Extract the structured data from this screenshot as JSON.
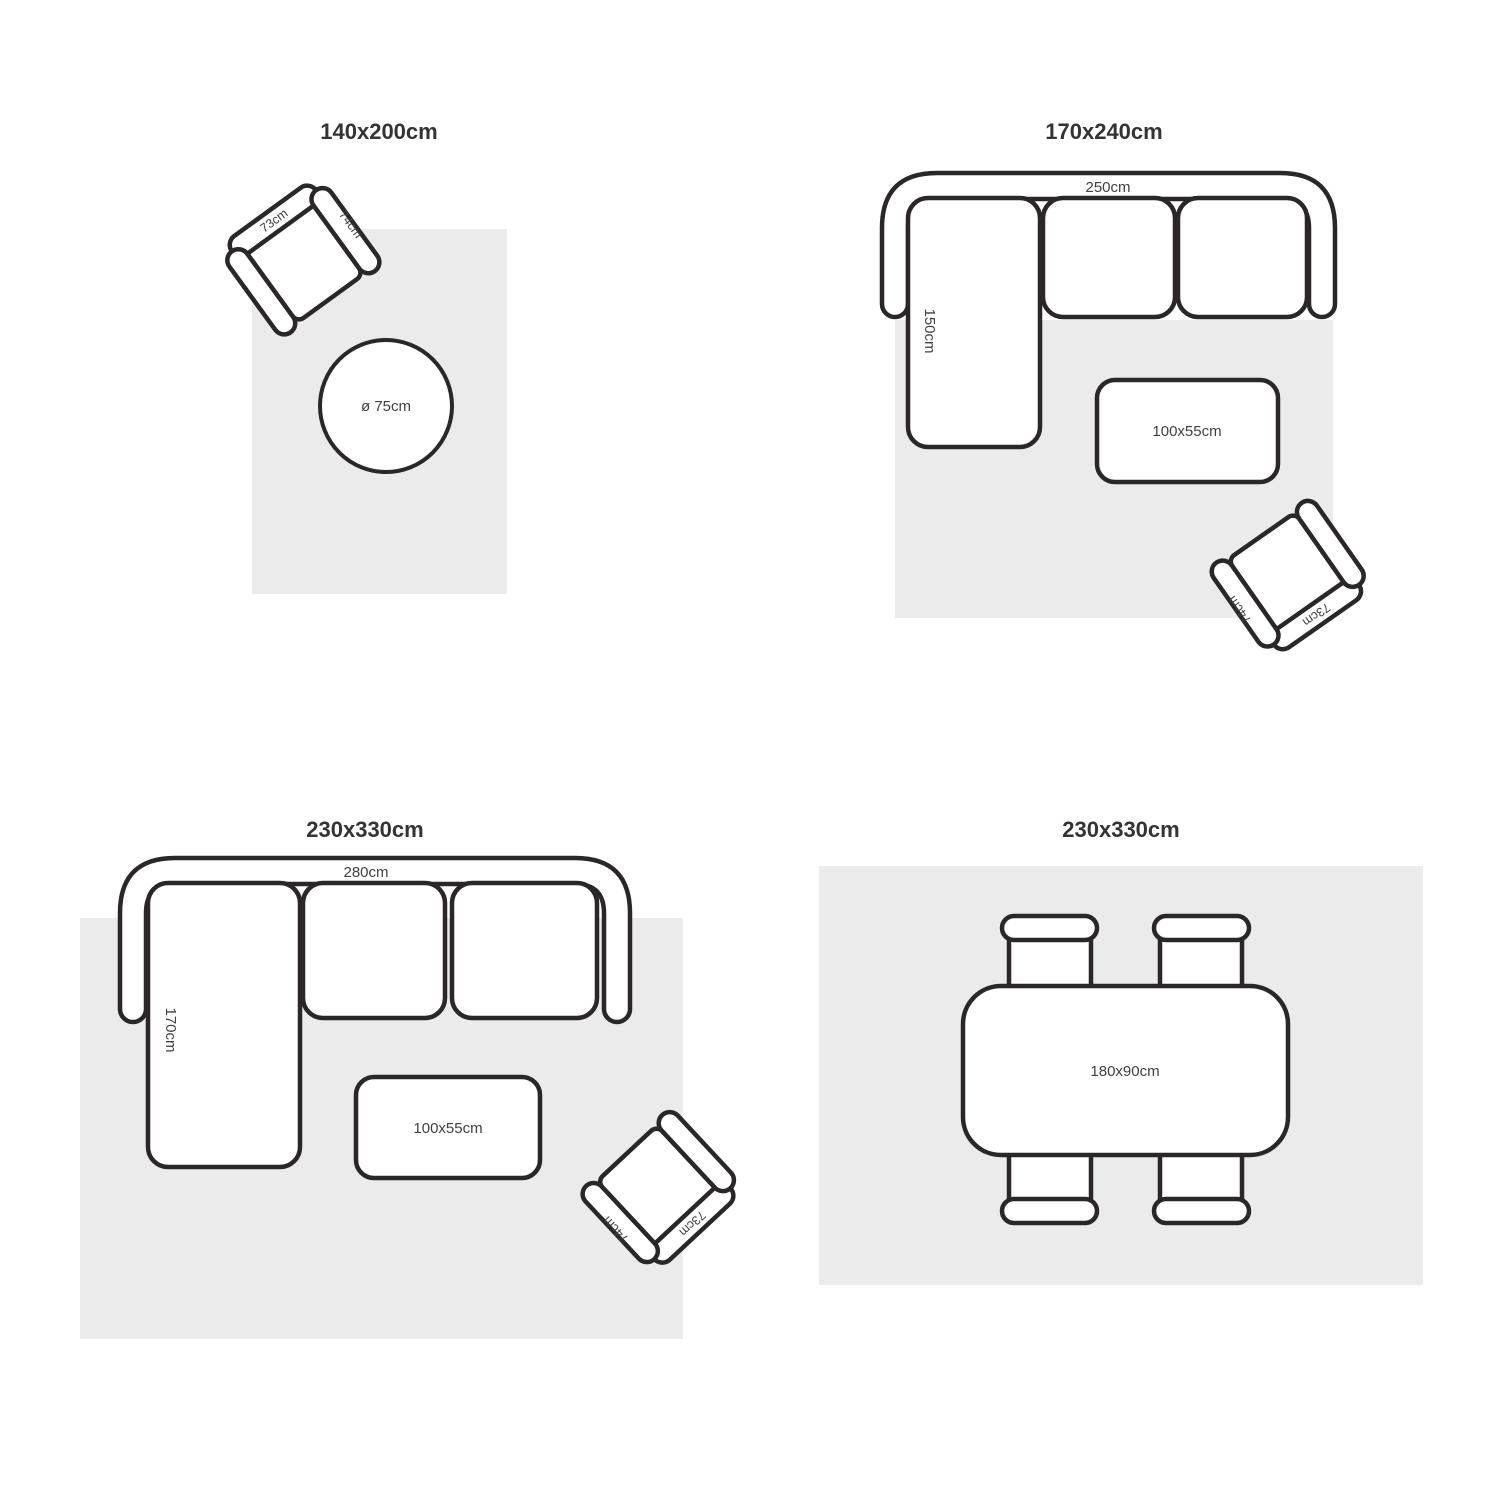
{
  "colors": {
    "outline": "#2b2728",
    "rug": "#ebebeb",
    "text": "#3f3f3f",
    "title": "#333333"
  },
  "panels": [
    {
      "title": "140x200cm",
      "pouf_label": "ø 75cm",
      "chair": {
        "back_label": "73cm",
        "arm_label": "74cm"
      }
    },
    {
      "title": "170x240cm",
      "sofa_width_label": "250cm",
      "chaise_depth_label": "150cm",
      "coffee_table_label": "100x55cm",
      "chair": {
        "back_label": "73cm",
        "arm_label": "74cm"
      }
    },
    {
      "title": "230x330cm",
      "sofa_width_label": "280cm",
      "chaise_depth_label": "170cm",
      "coffee_table_label": "100x55cm",
      "chair": {
        "back_label": "73cm",
        "arm_label": "74cm"
      }
    },
    {
      "title": "230x330cm",
      "dining_table_label": "180x90cm"
    }
  ]
}
